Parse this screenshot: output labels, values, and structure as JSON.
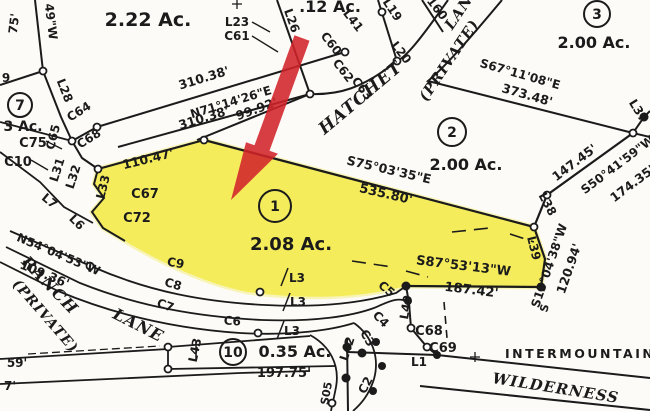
{
  "watermark": "INTERMOUNTAIN",
  "colors": {
    "highlight": "#f3e93a",
    "arrow": "#d2232a",
    "watermark_text": "#cdc0c2",
    "ink": "#1b1b1b"
  },
  "lots": {
    "lot1": {
      "num": "1",
      "area": "2.08 Ac."
    },
    "lot2": {
      "num": "2",
      "area": "2.00 Ac."
    },
    "lot3": {
      "num": "3",
      "area": "2.00 Ac."
    },
    "lot7": {
      "num": "7",
      "area": "3 Ac."
    },
    "lot10": {
      "num": "10",
      "area": "0.35 Ac."
    },
    "lot_top_left": {
      "area": "2.22 Ac."
    },
    "lot_top_center": {
      "area": ".12 Ac."
    }
  },
  "roads": {
    "hatchet": {
      "name": "HATCHET",
      "private": "(PRIVATE)",
      "lane": "LANE"
    },
    "ranch": {
      "name": "RANCH",
      "private": "(PRIVATE)",
      "lane": "LANE"
    },
    "wilderness": {
      "name": "WILDERNESS"
    }
  },
  "bearings": {
    "n71": "N71°14'26\"E",
    "s67": "S67°11'08\"E",
    "s75": "S75°03'35\"E",
    "s50": "S50°41'59\"W",
    "s15": "S15°04'38\"W",
    "s87": "S87°53'13\"W",
    "n54": "N54°04'53\"W",
    "s05_partial": "S05",
    "s_partial": "S",
    "w49_partial": "49\"W"
  },
  "distances": {
    "d310_upper": "310.38'",
    "d310_lower": "310.38'",
    "d9992": "99.92'",
    "d37348": "373.48'",
    "d14745": "147.45'",
    "d17435": "174.35'",
    "d12094": "120.94'",
    "d53580": "535.80'",
    "d11047": "110.47'",
    "d10936": "109.36'",
    "d18742": "187.42'",
    "d19775": "197.75'",
    "d75_partial": "75'",
    "d160_partial": "160",
    "d59_partial": "59'",
    "d7_partial": "7'"
  },
  "curve_labels": {
    "c61": "C61",
    "c60": "C60",
    "c62": "C62",
    "c63": "C63",
    "c64": "C64",
    "c65": "C65",
    "c68a": "C68",
    "c75": "C75",
    "c10": "C10",
    "c67": "C67",
    "c72": "C72",
    "c9": "C9",
    "c8": "C8",
    "c7": "C7",
    "c6": "C6",
    "c5": "C5",
    "c4": "C4",
    "c3": "C3",
    "c2": "C2",
    "c68b": "C68",
    "c69": "C69"
  },
  "line_labels": {
    "l23": "L23",
    "l26": "L26",
    "l41": "L41",
    "l19": "L19",
    "l20": "L20",
    "l37": "L37",
    "l38": "L38",
    "l39": "L39",
    "l40": "L40",
    "l28": "L28",
    "l31": "L31",
    "l32": "L32",
    "l33": "L33",
    "l7": "L7",
    "l6": "L6",
    "l3a": "L3",
    "l3b": "L3",
    "l3c": "L3",
    "l43": "L43",
    "l42": "L42",
    "l1": "L1",
    "l9_partial": "9"
  }
}
